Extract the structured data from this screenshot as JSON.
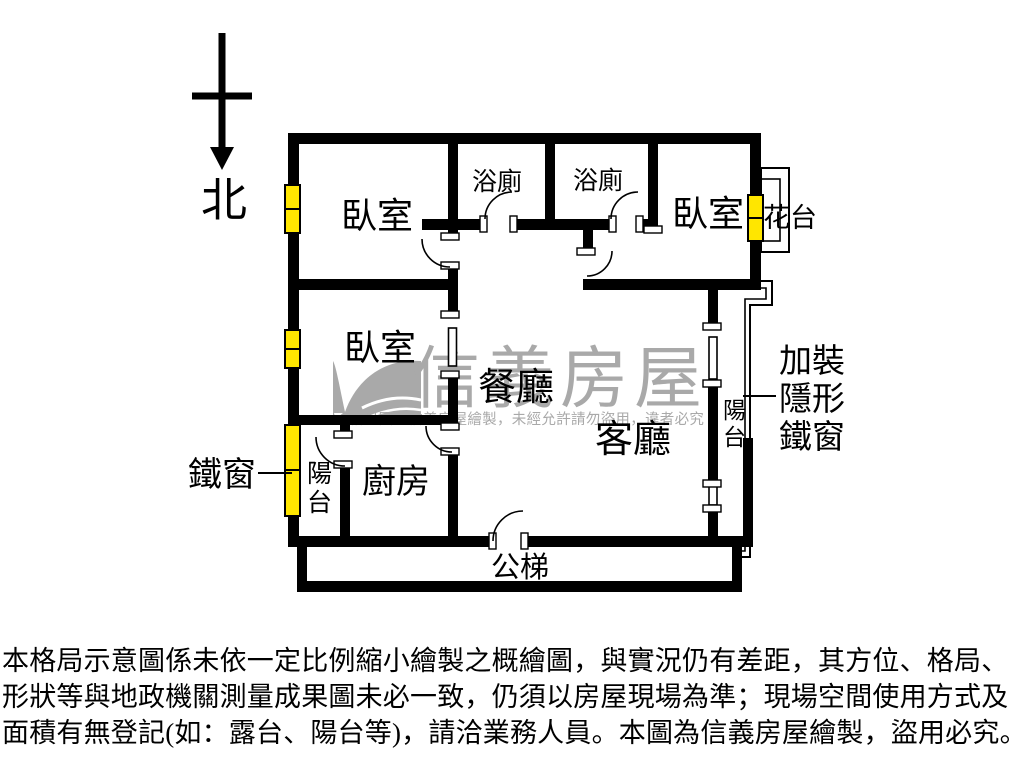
{
  "compass": {
    "label": "北"
  },
  "watermark": {
    "brand": "信義房屋",
    "notice": "格局圖為信義房屋繪製，未經允許請勿盜用，違者必究",
    "color": "#a9a9a9"
  },
  "rooms": {
    "bedroom_top_left": "臥室",
    "bedroom_top_right": "臥室",
    "bedroom_mid_left": "臥室",
    "bath_left": "浴廁",
    "bath_right": "浴廁",
    "dining": "餐廳",
    "living": "客廳",
    "kitchen": "廚房",
    "balcony_left": "陽台",
    "balcony_right": "陽台",
    "stairs": "公梯"
  },
  "annotations": {
    "flower_bed": "花台",
    "iron_window": "鐵窗",
    "hidden_grille_line1": "加裝",
    "hidden_grille_line2": "隱形",
    "hidden_grille_line3": "鐵窗"
  },
  "colors": {
    "wall": "#000000",
    "window": "#ffe600",
    "watermark": "#a9a9a9",
    "background": "#ffffff"
  },
  "disclaimer": {
    "line1": "本格局示意圖係未依一定比例縮小繪製之概繪圖，與實況仍有差距，其方位、格局、",
    "line2": "形狀等與地政機關測量成果圖未必一致，仍須以房屋現場為準；現場空間使用方式及",
    "line3": "面積有無登記(如：露台、陽台等)，請洽業務人員。本圖為信義房屋繪製，盜用必究。"
  }
}
